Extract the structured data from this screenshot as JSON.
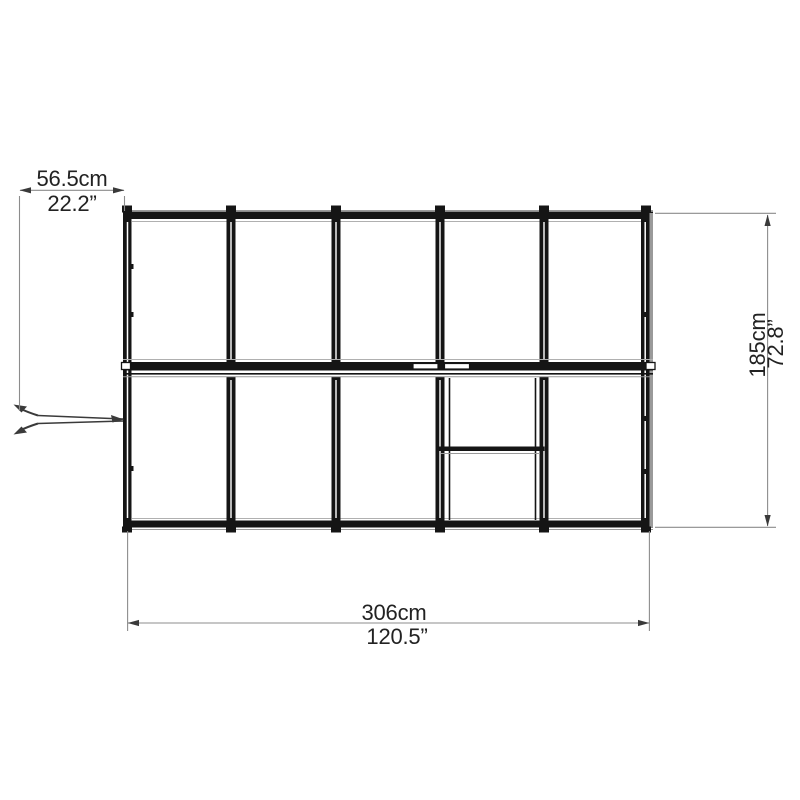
{
  "diagram": {
    "dims": {
      "top": {
        "metric": "56.5cm",
        "imperial": "22.2”"
      },
      "right": {
        "metric": "185cm",
        "imperial": "72.8”"
      },
      "bottom": {
        "metric": "306cm",
        "imperial": "120.5”"
      }
    },
    "colors": {
      "background": "#ffffff",
      "frame": "#151515",
      "frame_shadow": "#9a9a9a",
      "panel_line": "#b0b0b0",
      "dimension_line": "#8c8c8c",
      "arrow": "#3a3a3a",
      "text": "#222222"
    }
  }
}
